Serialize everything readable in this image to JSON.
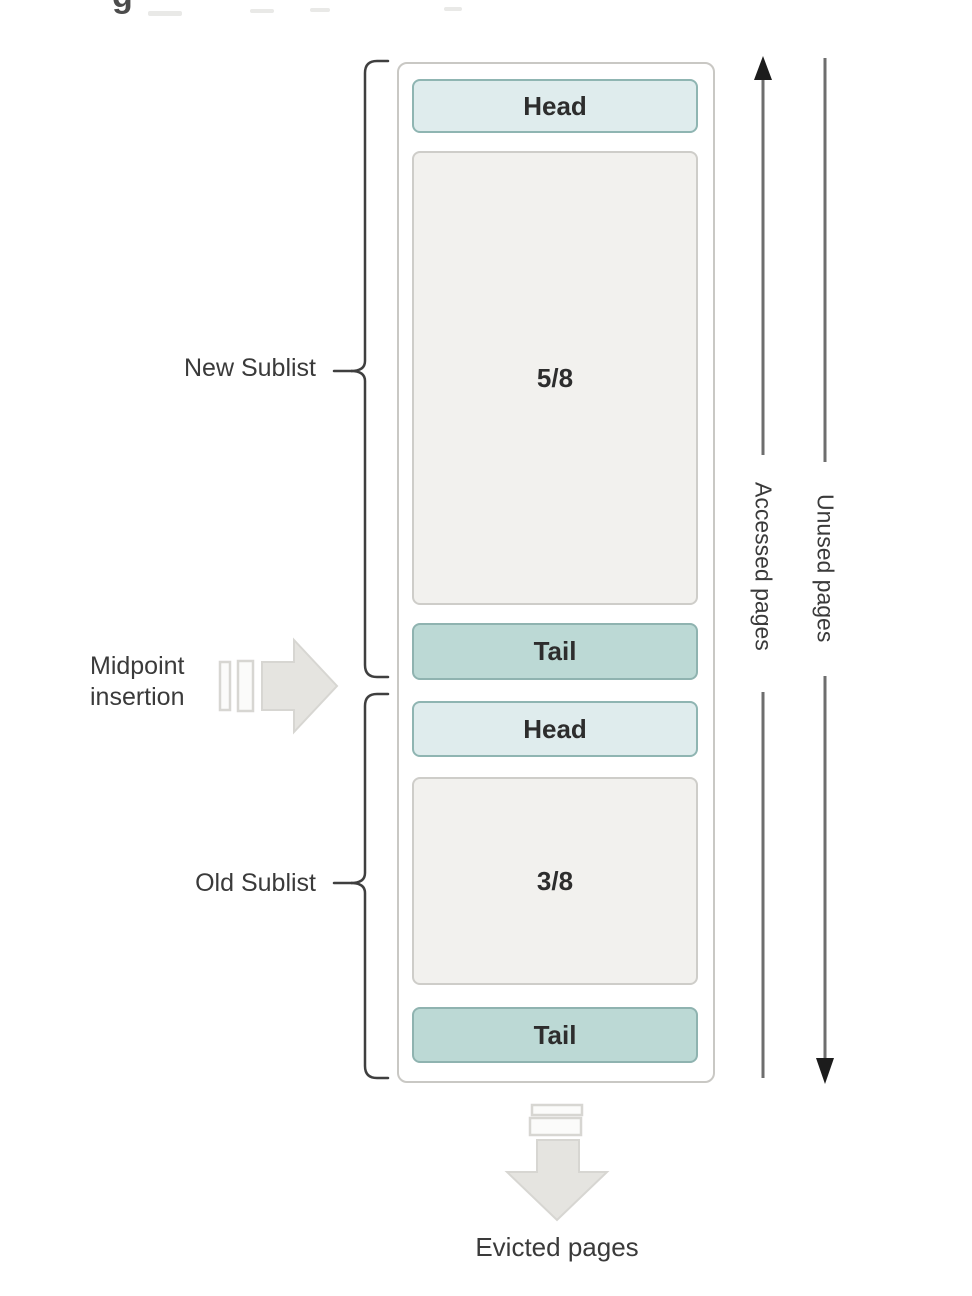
{
  "figure": {
    "cropped_caption_fragment": "g",
    "buffer_pool": {
      "new_sublist": {
        "head_label": "Head",
        "fraction_label": "5/8",
        "tail_label": "Tail"
      },
      "old_sublist": {
        "head_label": "Head",
        "fraction_label": "3/8",
        "tail_label": "Tail"
      }
    },
    "labels": {
      "new_sublist": "New Sublist",
      "midpoint_line1": "Midpoint",
      "midpoint_line2": "insertion",
      "old_sublist": "Old Sublist",
      "accessed_pages": "Accessed pages",
      "unused_pages": "Unused pages",
      "evicted_pages": "Evicted pages"
    },
    "colors": {
      "head_fill": "#dfeced",
      "head_border": "#8fb5b2",
      "tail_fill": "#bcd9d5",
      "tail_border": "#8fb3b0",
      "gray_box_fill": "#f2f1ee",
      "gray_box_border": "#cecdc9",
      "container_border": "#c9c8c4",
      "bracket_color": "#3f3f3f",
      "line_color": "#6e6e6e",
      "arrowhead_color": "#1c1c1c",
      "big_arrow_fill": "#e5e4e0",
      "big_arrow_stroke": "#d7d6d2",
      "bar_fill": "#fbfbfa",
      "text_color": "#3a3a3a",
      "box_text_color": "#2d2d2d"
    }
  }
}
